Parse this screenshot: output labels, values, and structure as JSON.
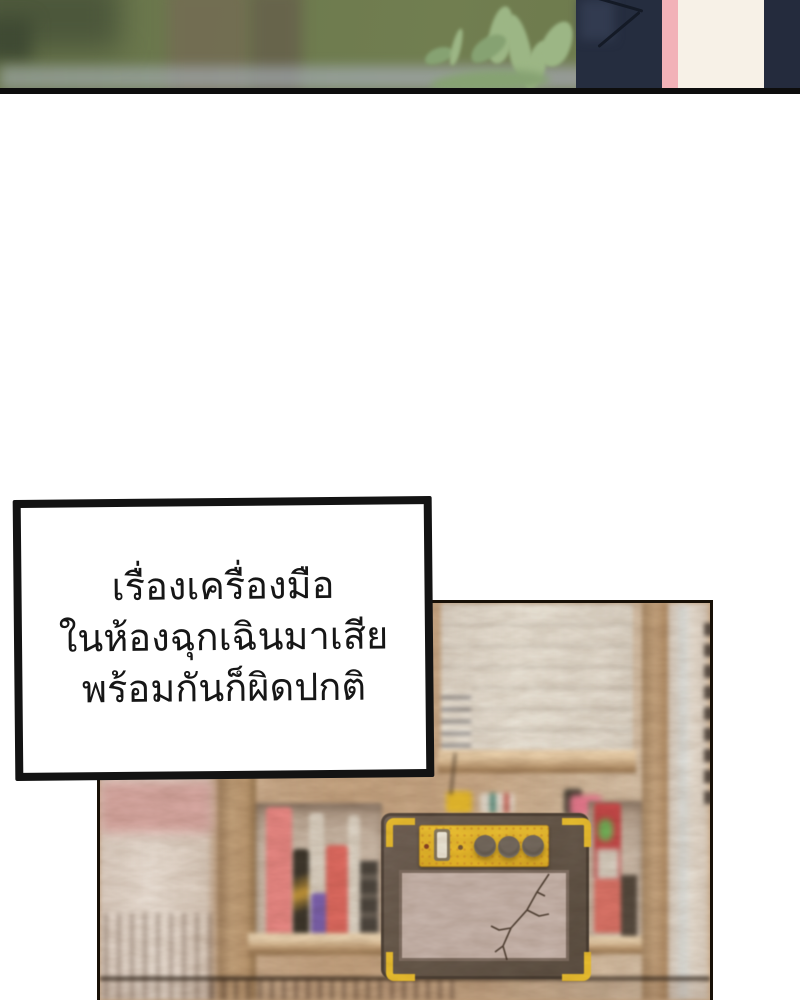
{
  "page": {
    "kind": "webtoon-comic-page",
    "language": "th",
    "background": "#ffffff"
  },
  "narration": {
    "lines": [
      "เรื่องเครื่องมือ",
      "ในห้องฉุกเฉินมาเสีย",
      "พร้อมกันก็ผิดปกติ"
    ]
  },
  "palette": {
    "panel_border": "#131313",
    "forest_green": "#6d7a4e",
    "leaf_green": "#9cb685",
    "jacket_navy": "#252d3f",
    "collar_pink": "#f2b2b8",
    "shirt_cream": "#f7f1e7",
    "wood_tan": "#c9a884",
    "amp_body": "#695b4d",
    "amp_yellow": "#edc230",
    "speaker_face": "#c9b7ae",
    "book_pink": "#e88884",
    "book_red": "#dd6a60",
    "book_purple": "#7b61ad",
    "red_box": "#c64949",
    "green_label": "#72b058"
  }
}
